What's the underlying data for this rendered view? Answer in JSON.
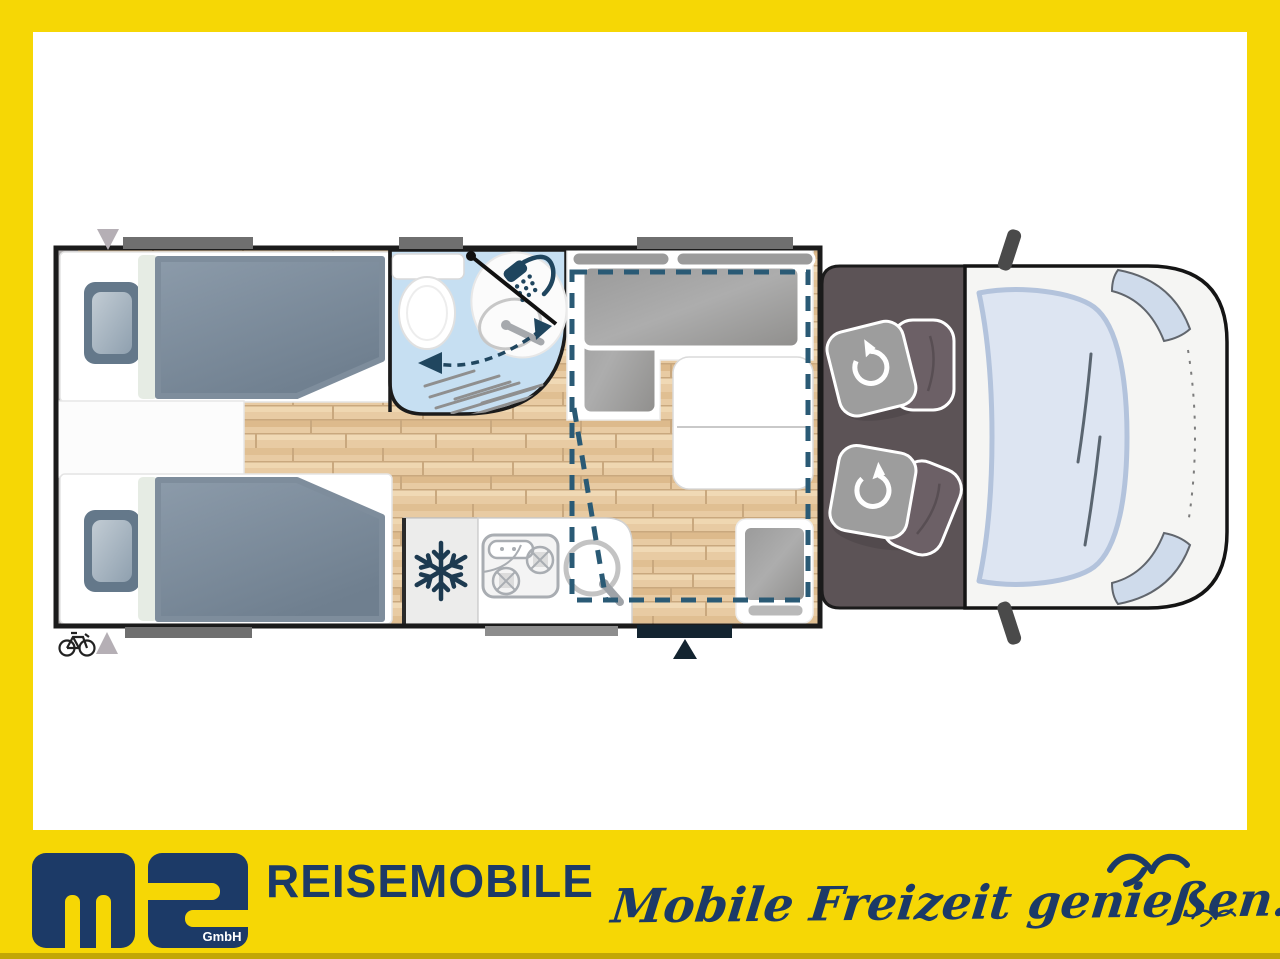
{
  "branding": {
    "logo_letters": "ms",
    "logo_company_suffix": "GmbH",
    "wordmark": "REISEMOBILE",
    "slogan": "Mobile Freizeit genießen."
  },
  "colors": {
    "frame_yellow": "#F6D705",
    "brand_navy": "#1C3A67",
    "plan_outline": "#1B1B1B",
    "wood_floor": "#E8CBA3",
    "bathroom_blue": "#C6DFF2",
    "cab_floor_gray": "#5C5356",
    "drop_down_bed_dash_teal": "#2A5A75",
    "cushion_gray": "#A7A7A7",
    "mattress_slate": "#7E8D9C",
    "window_bar_gray": "#6F6F6F",
    "door_navy": "#132430"
  },
  "floorplan": {
    "view": "motorhome top view floor plan, cab at right",
    "features": [
      "twin single bed top",
      "twin single bed bottom",
      "nightstand between beds",
      "bathroom with toilet, swivel washbasin and shower",
      "fridge with snowflake icon",
      "kitchen block with two-burner hob and round sink",
      "L-shaped dinette with headrests",
      "dinette table",
      "single seat at entrance",
      "drop-down bed dashed outline",
      "two swivel cab seats",
      "entrance door with arrow marker",
      "bike rack marker at rear"
    ],
    "icons": [
      "snowflake-icon",
      "shower-head-icon",
      "swivel-arrow-icon",
      "bicycle-icon",
      "seagull-icon",
      "entrance-arrow-icon",
      "marker-triangle-icon"
    ]
  }
}
